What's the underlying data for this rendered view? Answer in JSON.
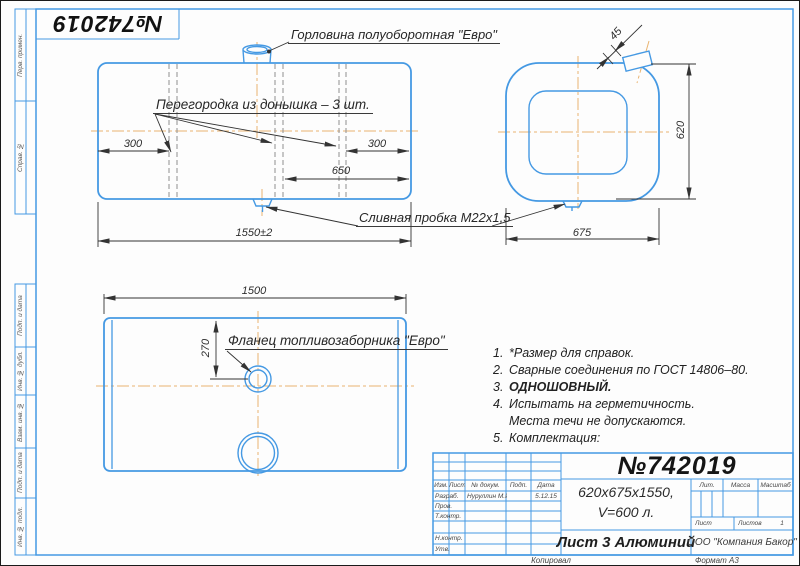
{
  "stamp": {
    "number": "№742019"
  },
  "margin": {
    "items": [
      {
        "label": "Перв. примен."
      },
      {
        "label": "Справ. №"
      },
      {
        "label": "Подп. и дата"
      },
      {
        "label": "Инв. № дубл."
      },
      {
        "label": "Взам. инв. №"
      },
      {
        "label": "Подп. и дата"
      },
      {
        "label": "Инв. № подл."
      }
    ]
  },
  "labels": {
    "neck": "Горловина полуоборотная \"Евро\"",
    "partition": "Перегородка из донышка – 3 шт.",
    "drain": "Сливная пробка М22х1,5",
    "flange": "Фланец топливозаборника \"Евро\""
  },
  "dims": {
    "front_left": "300",
    "front_right": "300",
    "front_mid": "650",
    "front_total": "1550±2",
    "end_stub": "45",
    "end_height": "620",
    "end_width": "675",
    "top_length": "1500",
    "top_offset": "270"
  },
  "notes": {
    "lines": [
      {
        "num": "1.",
        "text": "*Размер для справок."
      },
      {
        "num": "2.",
        "text": "Сварные соединения по ГОСТ 14806–80."
      },
      {
        "num": "3.",
        "text": "ОДНОШОВНЫЙ."
      },
      {
        "num": "4.",
        "text": "Испытать на герметичность."
      },
      {
        "num": "",
        "text": "Места течи не допускаются."
      },
      {
        "num": "5.",
        "text": "Комплектация:"
      }
    ]
  },
  "title_block": {
    "doc_number": "№742019",
    "size_line1": "620х675х1550,",
    "size_line2": "V=600 л.",
    "material": "Лист 3 Алюминий",
    "company": "ООО \"Компания Бакор\"",
    "col_izm": "Изм.",
    "col_list": "Лист",
    "col_doc": "№ докум.",
    "col_podp": "Подп.",
    "col_data": "Дата",
    "row_razrab": "Разраб.",
    "razrab_name": "Нуруллин М.И",
    "razrab_date": "5.12.15",
    "row_prov": "Пров.",
    "row_tkontr": "Т.контр.",
    "row_nkontr": "Н.контр.",
    "row_utv": "Утв.",
    "lit": "Лит.",
    "massa": "Масса",
    "masshtab": "Масштаб",
    "list_label": "Лист",
    "listov_label": "Листов",
    "listov_value": "1"
  },
  "footer": {
    "copied": "Копировал",
    "format_label": "Формат",
    "format_value": "А3"
  },
  "colors": {
    "line_blue": "#4599e3",
    "centerline_orange": "#e9b471",
    "ink": "#333333"
  }
}
